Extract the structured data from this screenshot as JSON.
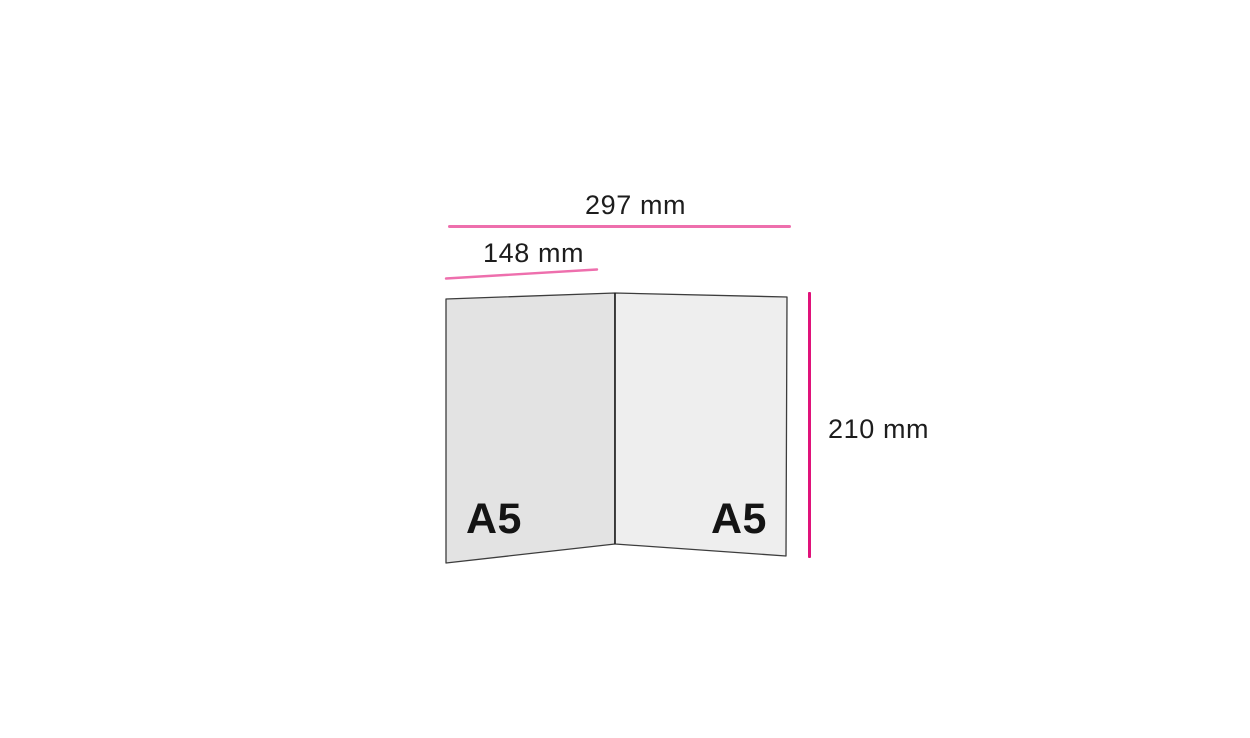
{
  "diagram": {
    "type": "folded-sheet-dimensions",
    "labels": {
      "width_total": "297 mm",
      "width_half": "148 mm",
      "height": "210 mm",
      "panel_left": "A5",
      "panel_right": "A5"
    },
    "dimensions": {
      "total_width_mm": 297,
      "half_width_mm": 148,
      "height_mm": 210,
      "panel_count": 2
    }
  },
  "colors": {
    "background": "#ffffff",
    "accent_pink": "#ee6fad",
    "accent_magenta": "#e0127a",
    "panel_left_fill": "#e3e3e3",
    "panel_right_fill": "#eeeeee",
    "panel_stroke": "#3d3d3d",
    "fold_stroke": "#1c1c1c",
    "text": "#1d1d1d"
  }
}
